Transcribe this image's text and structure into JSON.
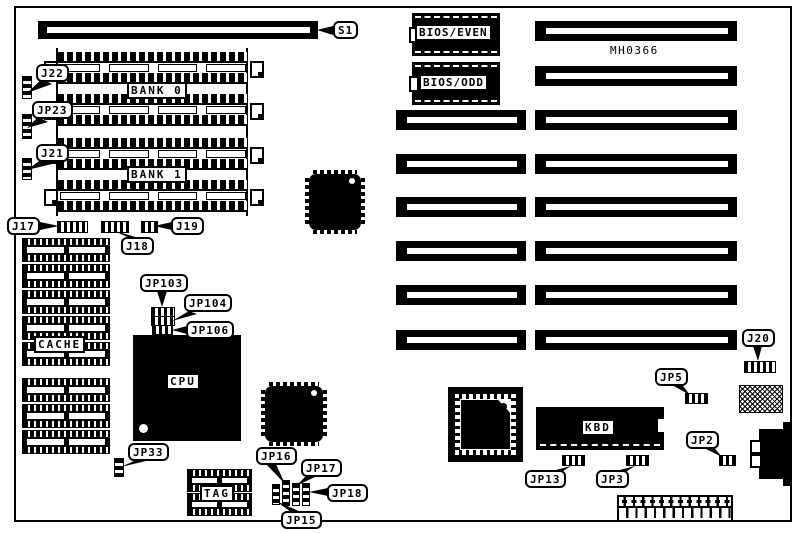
{
  "diagram": {
    "board_id": "MH0366",
    "callouts": {
      "s1": "S1",
      "j22": "J22",
      "jp23": "JP23",
      "j21": "J21",
      "j17": "J17",
      "j18": "J18",
      "j19": "J19",
      "jp103": "JP103",
      "jp104": "JP104",
      "jp106": "JP106",
      "jp33": "JP33",
      "jp15": "JP15",
      "jp16": "JP16",
      "jp17": "JP17",
      "jp18": "JP18",
      "j20": "J20",
      "jp5": "JP5",
      "jp2": "JP2",
      "jp13": "JP13",
      "jp3": "JP3"
    },
    "chip_labels": {
      "bank0": "BANK 0",
      "bank1": "BANK 1",
      "cache": "CACHE",
      "cpu": "CPU",
      "tag": "TAG",
      "kbd": "KBD",
      "bios_even": "BIOS/EVEN",
      "bios_odd": "BIOS/ODD"
    }
  }
}
